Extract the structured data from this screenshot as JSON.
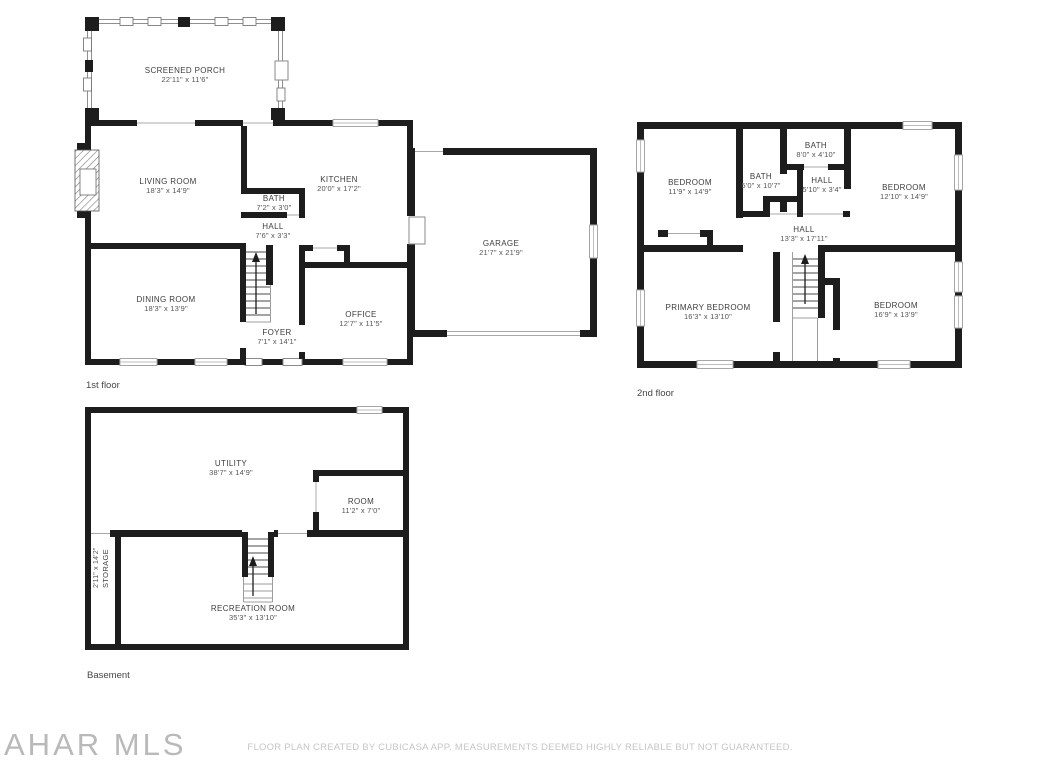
{
  "colors": {
    "wall": "#1d1d1d",
    "label_text": "#3d3d3d",
    "dims_text": "#565656",
    "muted_footer": "#c6c6c6",
    "thin_line": "#a8a8a8"
  },
  "floors": {
    "first": {
      "caption": "1st floor",
      "rooms": {
        "screened_porch": {
          "name": "SCREENED PORCH",
          "dims": "22'11\" x 11'6\""
        },
        "living_room": {
          "name": "LIVING ROOM",
          "dims": "18'3\" x 14'9\""
        },
        "kitchen": {
          "name": "KITCHEN",
          "dims": "20'0\" x 17'2\""
        },
        "bath": {
          "name": "BATH",
          "dims": "7'2\" x 3'0\""
        },
        "hall": {
          "name": "HALL",
          "dims": "7'6\" x 3'3\""
        },
        "dining_room": {
          "name": "DINING ROOM",
          "dims": "18'3\" x 13'9\""
        },
        "foyer": {
          "name": "FOYER",
          "dims": "7'1\" x 14'1\""
        },
        "office": {
          "name": "OFFICE",
          "dims": "12'7\" x 11'5\""
        },
        "garage": {
          "name": "GARAGE",
          "dims": "21'7\" x 21'9\""
        }
      }
    },
    "second": {
      "caption": "2nd floor",
      "rooms": {
        "bedroom_left": {
          "name": "BEDROOM",
          "dims": "11'9\" x 14'9\""
        },
        "bath_inner": {
          "name": "BATH",
          "dims": "5'0\" x 10'7\""
        },
        "bath_top": {
          "name": "BATH",
          "dims": "8'0\" x 4'10\""
        },
        "hall_small": {
          "name": "HALL",
          "dims": "5'10\" x 3'4\""
        },
        "bedroom_right": {
          "name": "BEDROOM",
          "dims": "12'10\" x 14'9\""
        },
        "hall_main": {
          "name": "HALL",
          "dims": "13'3\" x 17'11\""
        },
        "primary_bedroom": {
          "name": "PRIMARY BEDROOM",
          "dims": "16'3\" x 13'10\""
        },
        "bedroom_bottom_right": {
          "name": "BEDROOM",
          "dims": "16'9\" x 13'9\""
        }
      }
    },
    "basement": {
      "caption": "Basement",
      "rooms": {
        "utility": {
          "name": "UTILITY",
          "dims": "38'7\" x 14'9\""
        },
        "room": {
          "name": "ROOM",
          "dims": "11'2\" x 7'0\""
        },
        "storage": {
          "name": "STORAGE",
          "dims": "2'11\" x 14'2\""
        },
        "recreation_room": {
          "name": "RECREATION ROOM",
          "dims": "35'3\" x 13'10\""
        }
      }
    }
  },
  "footer": {
    "logo": "AHAR MLS",
    "disclaimer": "FLOOR PLAN CREATED BY CUBICASA APP. MEASUREMENTS DEEMED HIGHLY RELIABLE BUT NOT GUARANTEED."
  }
}
